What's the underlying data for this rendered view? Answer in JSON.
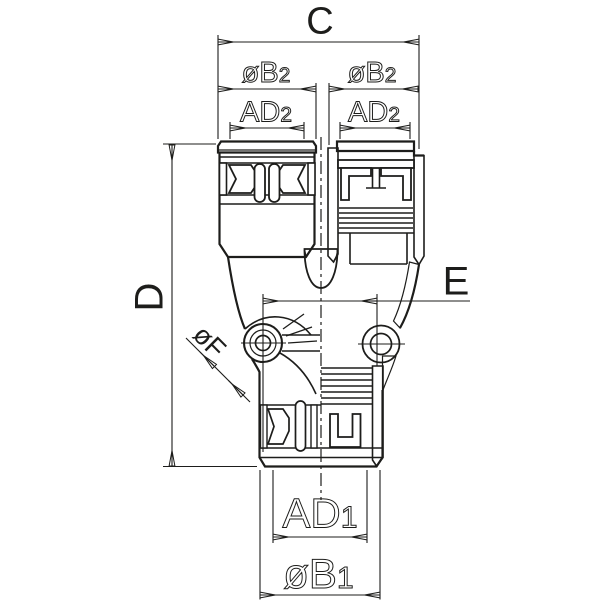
{
  "drawing": {
    "type": "technical-dimension-drawing",
    "labels": {
      "c": "C",
      "b2": {
        "main": "øB",
        "sub": "2"
      },
      "ad2": {
        "main": "AD",
        "sub": "2"
      },
      "d": "D",
      "e": "E",
      "f": "øF",
      "ad1": {
        "main": "AD",
        "sub": "1"
      },
      "b1": {
        "main": "øB",
        "sub": "1"
      }
    },
    "colors": {
      "line": "#1d1d1b",
      "background": "#ffffff"
    }
  }
}
